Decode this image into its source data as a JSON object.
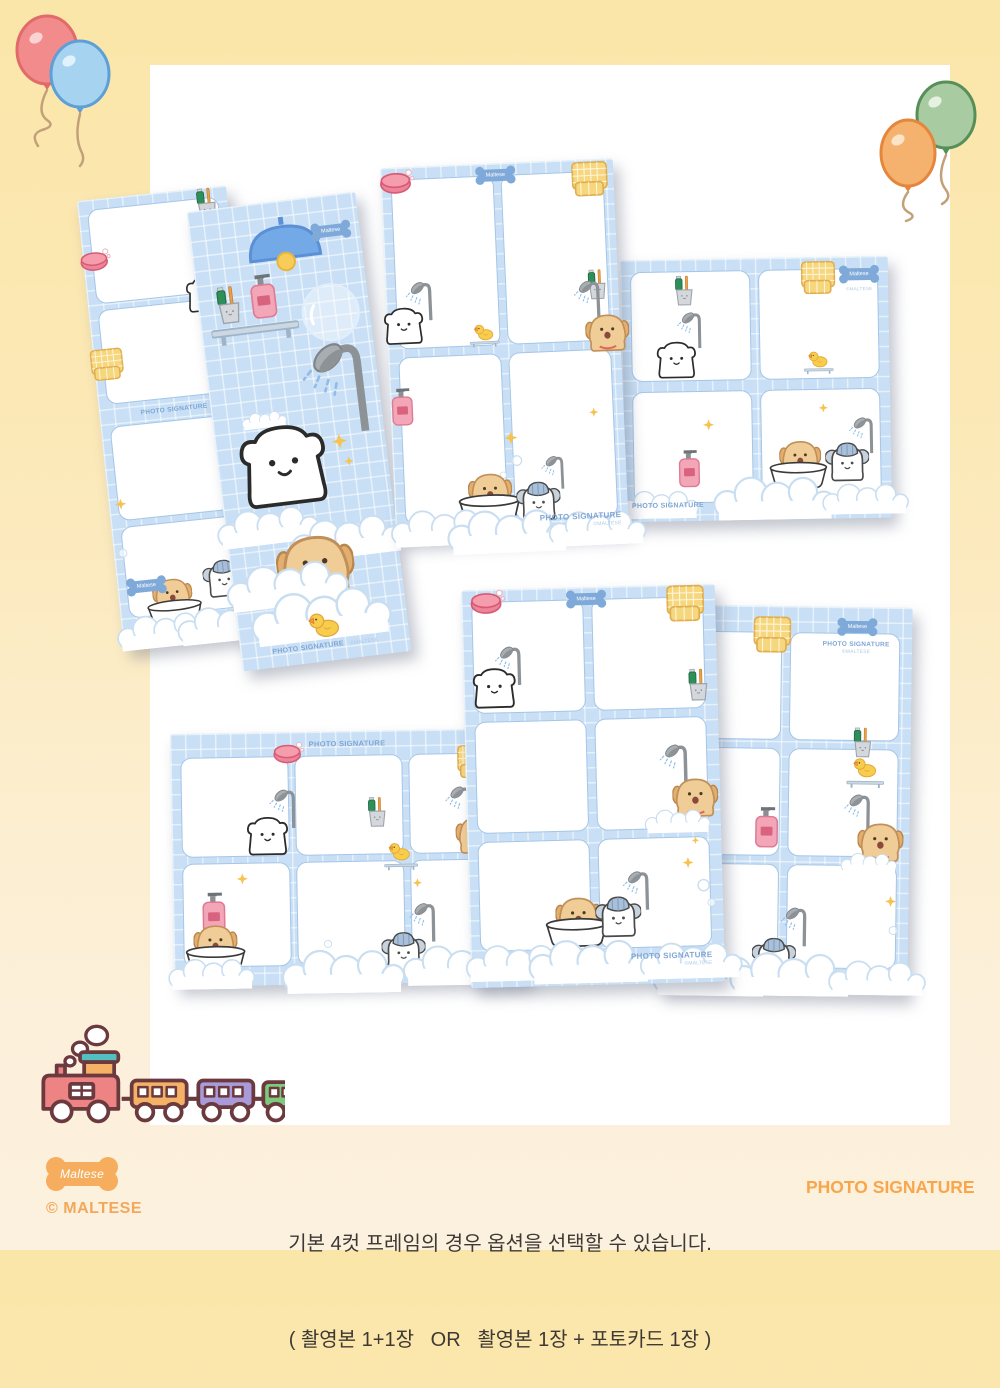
{
  "page": {
    "bg_top": "#FBE6A9",
    "bg_bottom": "#FCF1DE",
    "canvas_color": "#FFFFFF"
  },
  "branding": {
    "bone_label": "Maltese",
    "copyright": "© MALTESE",
    "wordmark": "PHOTO SIGNATURE"
  },
  "caption": {
    "line1": "기본 4컷 프레임의 경우 옵션을 선택할 수 있습니다.",
    "line2": "( 촬영본 1+1장   OR   촬영본 1장 + 포토카드 1장 )"
  },
  "frames": {
    "watermark": "PHOTO SIGNATURE",
    "watermark_sub": "©MALTESE",
    "theme": "blue gingham bath-time",
    "colors": {
      "gingham": "#C8DFF5",
      "grid_line": "#FFFFFF",
      "slot_border": "#A5C6E8",
      "bone_tag": "#7FA9D8"
    },
    "items": [
      {
        "id": "strip-4cut",
        "label": "vertical 4-cut strip frame",
        "slots": 4
      },
      {
        "id": "artwork-strip",
        "label": "bath scene artwork strip",
        "slots": 0
      },
      {
        "id": "portrait-4cut",
        "label": "portrait 4-cut frame",
        "slots": 4
      },
      {
        "id": "landscape-4cut",
        "label": "landscape 4-cut frame",
        "slots": 4
      },
      {
        "id": "portrait-6cut",
        "label": "portrait 6-cut frame",
        "slots": 6
      },
      {
        "id": "portrait-6cut-right",
        "label": "portrait 6-cut frame",
        "slots": 6
      },
      {
        "id": "landscape-6cut",
        "label": "landscape 6-cut frame",
        "slots": 6
      }
    ]
  },
  "icons": {
    "balloon-red": "#F28B8B",
    "balloon-blue": "#A6D3F0",
    "balloon-orange": "#F5B26E",
    "balloon-green": "#A9CBA2",
    "soap-icon": "pink soap bar",
    "rubber-duck-icon": "yellow rubber duck",
    "towel-icon": "yellow checked washcloth",
    "bone-tag-icon": "blue bone badge",
    "shower-icon": "gray shower head with spray",
    "soap-bottle-icon": "pink pump bottle",
    "toothbrush-cup-icon": "cup with toothpaste and toothbrush",
    "bear-icon": "white maltese puppy",
    "puppy-icon": "tan puppy",
    "elephant-icon": "puppy wearing shower cap",
    "bathtub-icon": "white oval tub",
    "sparkle-icon": "yellow sparkle",
    "lamp-icon": "blue ceiling lamp",
    "shelf-icon": "bathroom wall shelf",
    "bubble-icon": "soap bubble",
    "suds-icon": "foam cloud",
    "train-icon": "toy train with three cars"
  }
}
